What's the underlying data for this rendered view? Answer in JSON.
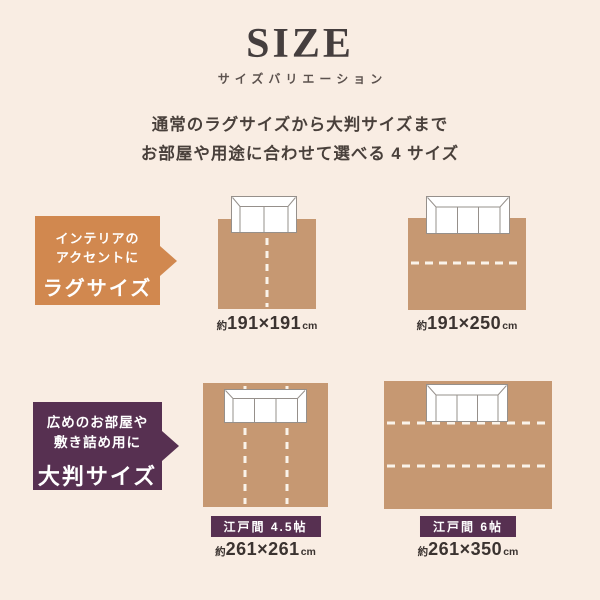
{
  "colors": {
    "bg": "#f9ede3",
    "rug": "#c69872",
    "orange": "#d1884f",
    "purple": "#573051",
    "seam": "#faf3ea",
    "ink": "#453e3e",
    "text": "#49403b",
    "caption": "#3b3330",
    "sofa_line": "#96908b"
  },
  "header": {
    "title": "SIZE",
    "subtitle": "サイズバリエーション",
    "description_line1": "通常のラグサイズから大判サイズまで",
    "description_line2": "お部屋や用途に合わせて選べる 4 サイズ"
  },
  "callouts": {
    "rug_size": {
      "line1": "インテリアの",
      "line2": "アクセントに",
      "title": "ラグサイズ"
    },
    "large_size": {
      "line1": "広めのお部屋や",
      "line2": "敷き詰め用に",
      "title": "大判サイズ"
    }
  },
  "diagrams": [
    {
      "name": "rug-191x191",
      "sofa": "2-seater-sofa",
      "seams": "1 vertical dashed seam",
      "size_prefix": "約",
      "dimensions": "191×191",
      "unit": "cm"
    },
    {
      "name": "rug-191x250",
      "sofa": "3-seater-sofa",
      "seams": "1 horizontal dashed seam",
      "size_prefix": "約",
      "dimensions": "191×250",
      "unit": "cm"
    },
    {
      "name": "rug-261x261",
      "badge": "江戸間 4.5帖",
      "sofa": "3-seater-sofa",
      "seams": "2 vertical dashed seams",
      "size_prefix": "約",
      "dimensions": "261×261",
      "unit": "cm"
    },
    {
      "name": "rug-261x350",
      "badge": "江戸間 6帖",
      "sofa": "3-seater-sofa",
      "seams": "2 horizontal dashed seams",
      "size_prefix": "約",
      "dimensions": "261×350",
      "unit": "cm"
    }
  ]
}
